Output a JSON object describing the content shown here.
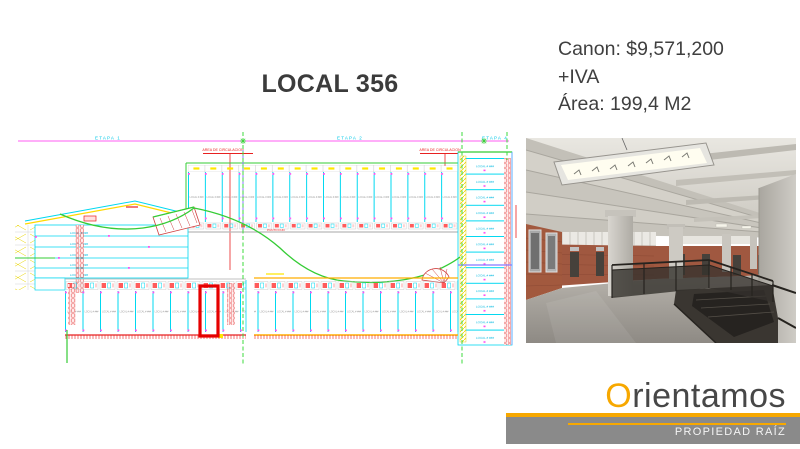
{
  "slide": {
    "title": "LOCAL 356",
    "canon": "Canon: $9,571,200",
    "iva": "+IVA",
    "area": "Área: 199,4 M2"
  },
  "floorplan": {
    "etapa_labels": [
      "ETAPA 1",
      "ETAPA 2",
      "ETAPA 4"
    ],
    "circulation_label_1": "AREA DE CIRCULACION",
    "circulation_label_2": "AREA DE CIRCULACION",
    "corridor_label": "PUNTO FIJO",
    "unit_label": "LOCAL # ###",
    "highlight_color": "#e60000"
  },
  "photo": {
    "alt": "Empty industrial floor: concrete ribbed ceiling with strip light, brick walls, columns, polished floor and stair opening with dark railings"
  },
  "logo": {
    "brand_initial": "O",
    "brand_rest": "rientamos",
    "tagline": "PROPIEDAD RAÍZ",
    "accent_color": "#F7A800",
    "bar_color": "#8A8A8A"
  }
}
